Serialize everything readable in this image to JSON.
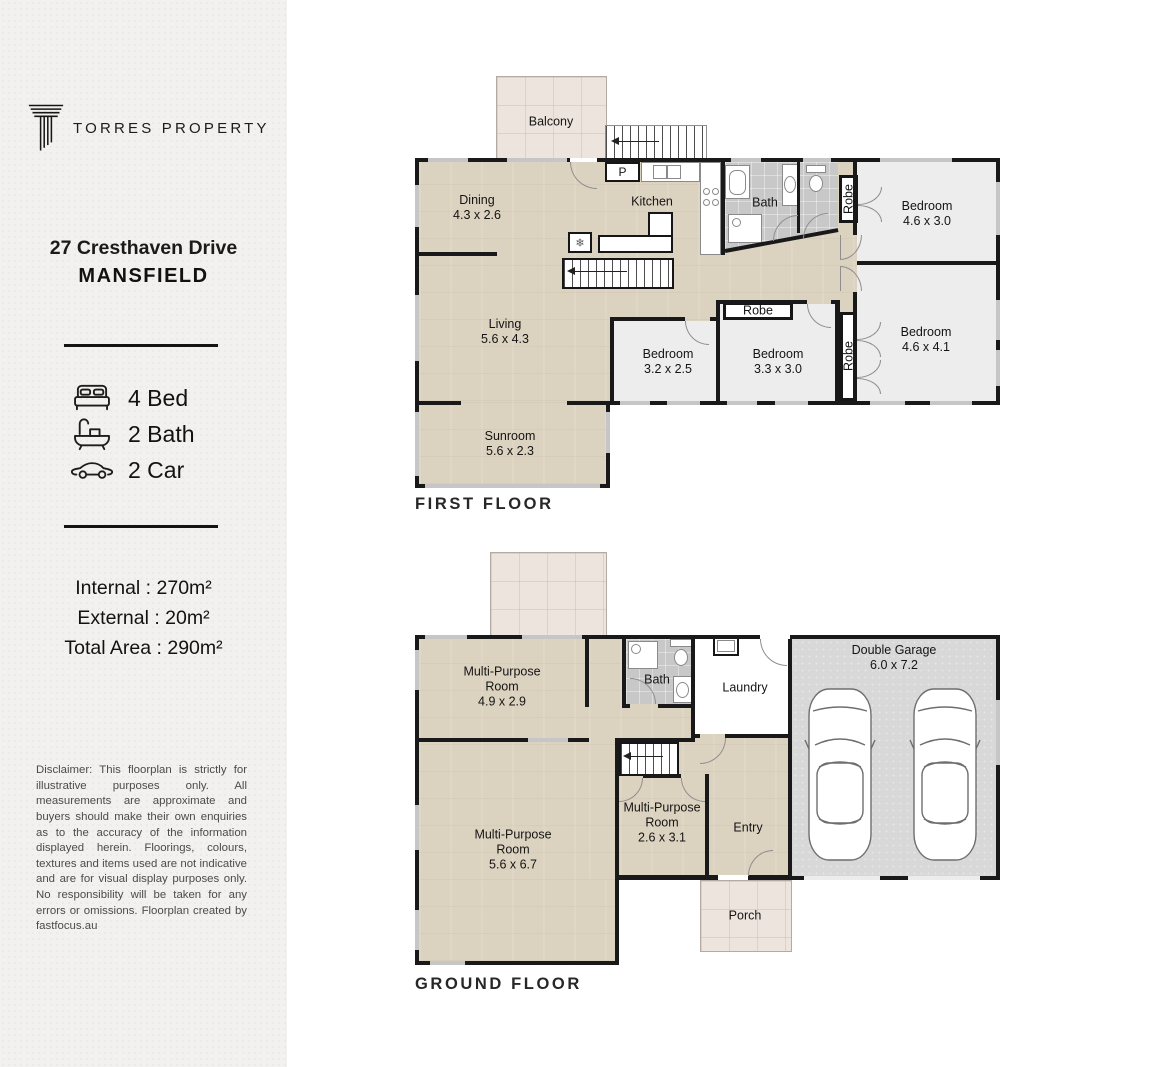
{
  "sidebar": {
    "brand": "TORRES PROPERTY",
    "address_line1": "27 Cresthaven Drive",
    "address_line2": "MANSFIELD",
    "stats": {
      "bed": "4 Bed",
      "bath": "2 Bath",
      "car": "2 Car"
    },
    "areas": {
      "internal": "Internal : 270m²",
      "external": "External : 20m²",
      "total": "Total Area : 290m²"
    },
    "disclaimer": "Disclaimer: This floorplan is strictly for illustrative purposes only. All measurements are approximate and buyers should make their own enquiries as to the accuracy of the information displayed herein. Floorings, colours, textures and items used are not indicative and are for visual display purposes only. No responsibility will be taken for any errors or omissions. Floorplan created by fastfocus.au"
  },
  "first_floor": {
    "caption": "FIRST FLOOR",
    "balcony": {
      "name": "Balcony"
    },
    "dining": {
      "name": "Dining",
      "dims": "4.3 x 2.6"
    },
    "kitchen": {
      "name": "Kitchen"
    },
    "pantry": {
      "name": "P"
    },
    "bath": {
      "name": "Bath"
    },
    "robe1": {
      "name": "Robe"
    },
    "robe2": {
      "name": "Robe"
    },
    "robe3": {
      "name": "Robe"
    },
    "bedroom1": {
      "name": "Bedroom",
      "dims": "4.6 x 3.0"
    },
    "bedroom2": {
      "name": "Bedroom",
      "dims": "4.6 x 4.1"
    },
    "bedroom3": {
      "name": "Bedroom",
      "dims": "3.3 x 3.0"
    },
    "bedroom4": {
      "name": "Bedroom",
      "dims": "3.2 x 2.5"
    },
    "living": {
      "name": "Living",
      "dims": "5.6 x 4.3"
    },
    "sunroom": {
      "name": "Sunroom",
      "dims": "5.6 x 2.3"
    }
  },
  "ground_floor": {
    "caption": "GROUND FLOOR",
    "mpr1": {
      "name": "Multi-Purpose Room",
      "dims": "4.9 x 2.9"
    },
    "mpr2": {
      "name": "Multi-Purpose Room",
      "dims": "5.6 x 6.7"
    },
    "mpr3": {
      "name": "Multi-Purpose Room",
      "dims": "2.6 x 3.1"
    },
    "bath": {
      "name": "Bath"
    },
    "laundry": {
      "name": "Laundry"
    },
    "garage": {
      "name": "Double Garage",
      "dims": "6.0 x 7.2"
    },
    "entry": {
      "name": "Entry"
    },
    "porch": {
      "name": "Porch"
    }
  },
  "icons": {
    "fridge": "❄"
  },
  "colors": {
    "sidebar_bg": "#f2f1ef",
    "wall": "#191919",
    "wood_floor": "#dcd2c0",
    "carpet": "#ededed",
    "bath_tile": "#c8c8c8",
    "garage_floor": "#d8d8d8",
    "outdoor_tile": "#ece4dd",
    "window": "#c6c6c6"
  }
}
